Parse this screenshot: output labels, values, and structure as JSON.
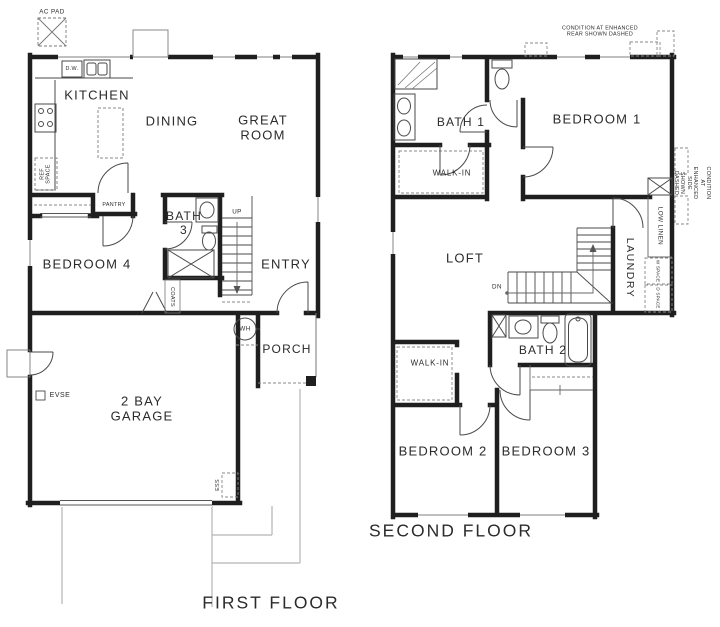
{
  "page": {
    "background": "#ffffff",
    "ink": "#1f1f1f",
    "thin_line": "#4a4a4a",
    "dashed_line": "#888888",
    "site_line": "#b5b5b5"
  },
  "first_floor": {
    "caption": "FIRST FLOOR",
    "rooms": {
      "kitchen": "KITCHEN",
      "dining": "DINING",
      "great_room": "GREAT\nROOM",
      "bedroom4": "BEDROOM 4",
      "bath3": "BATH\n3",
      "entry": "ENTRY",
      "porch": "PORCH",
      "garage": "2 BAY\nGARAGE"
    },
    "labels": {
      "ac_pad": "AC PAD",
      "dw": "D.W.",
      "ref_space": "REF\nSPACE",
      "pantry": "PANTRY",
      "up": "UP",
      "coats": "COATS",
      "wh": "WH",
      "evse": "EVSE",
      "ess": "ESS"
    }
  },
  "second_floor": {
    "caption": "SECOND FLOOR",
    "rooms": {
      "bath1": "BATH 1",
      "bedroom1": "BEDROOM 1",
      "walk_in1": "WALK-IN",
      "loft": "LOFT",
      "laundry": "LAUNDRY",
      "bath2": "BATH 2",
      "walk_in2": "WALK-IN",
      "bedroom2": "BEDROOM 2",
      "bedroom3": "BEDROOM 3"
    },
    "labels": {
      "condition_rear": "CONDITION AT ENHANCED\nREAR SHOWN DASHED",
      "condition_side": "CONDITION AT ENHANCED\nSIDE SHOWN DASHED",
      "low_linen": "LOW LINEN",
      "w_space": "W SPACE",
      "d_space": "D SPACE",
      "dn": "DN"
    }
  }
}
